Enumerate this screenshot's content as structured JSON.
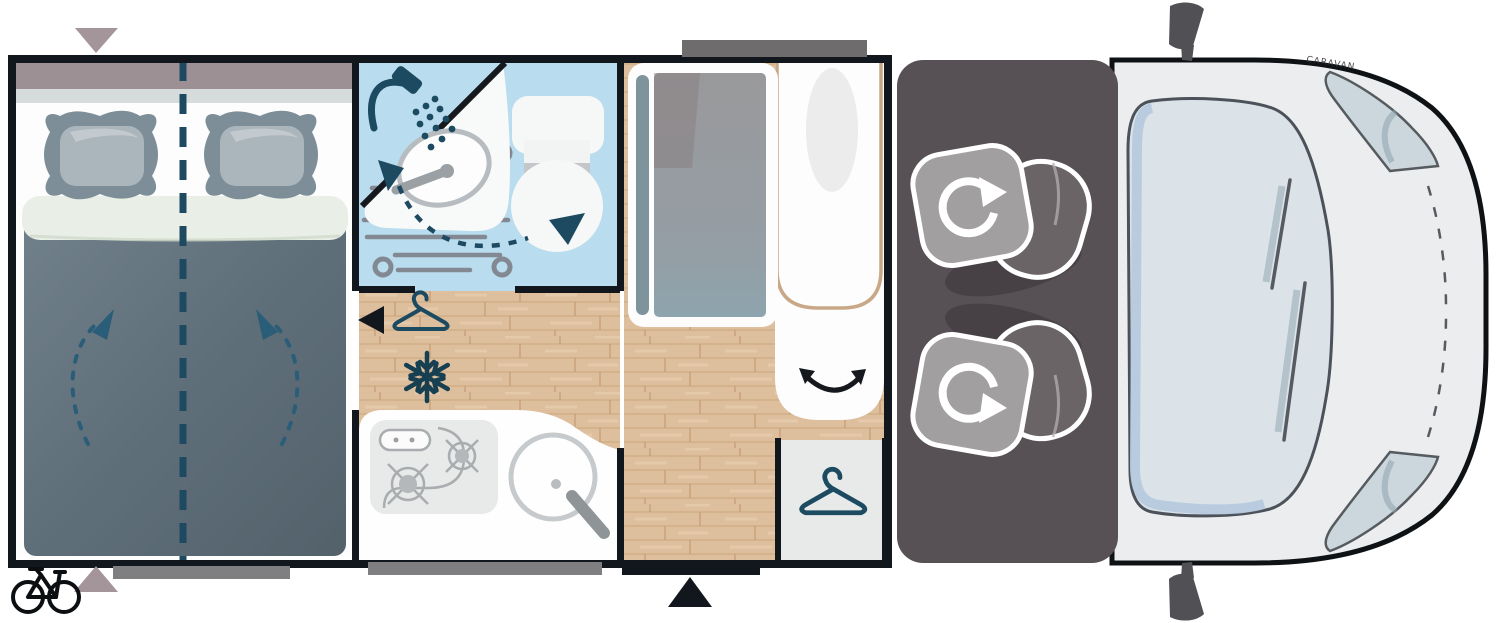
{
  "title": "Camper van floor plan (top view)",
  "van": {
    "watermark": "CARAVAN"
  },
  "colors": {
    "wall": "#12171d",
    "wood": "#ddbf9e",
    "bath_blue": "#b9dcee",
    "duvet": "#5f6f79",
    "accent_teal": "#1c4a61",
    "cab_gray": "#575155",
    "van_body": "#ecedee",
    "windshield": "#dce3e8",
    "beige_door": "#c9a888",
    "mauve_marker": "#a4959b",
    "window_gray": "#7f7f81",
    "fixture_gray": "#9aa0a4"
  },
  "areas": [
    {
      "name": "bedroom",
      "feature": "double-bed-with-center-split"
    },
    {
      "name": "bathroom",
      "feature": "shower-sink-toilet"
    },
    {
      "name": "kitchen",
      "feature": "two-burner-stove-and-round-sink"
    },
    {
      "name": "wardrobe-fridge-column",
      "feature": "tall-cabinet"
    },
    {
      "name": "entrance",
      "feature": "door-swing-area"
    },
    {
      "name": "closet",
      "feature": "hanging-wardrobe"
    },
    {
      "name": "cab",
      "feature": "two-swivel-seats"
    },
    {
      "name": "vehicle-front",
      "feature": "windshield-mirrors-headlights"
    }
  ],
  "icons": [
    "bike-rack-icon",
    "bed-marker-arrow-icon",
    "shower-icon",
    "faucet-swivel-arrow-icon",
    "hanger-icon",
    "snowflake-icon",
    "door-swing-arrow-icon",
    "entry-step-arrow-icon",
    "seat-swivel-arrow-icon",
    "window-bar",
    "entry-door-bar"
  ]
}
